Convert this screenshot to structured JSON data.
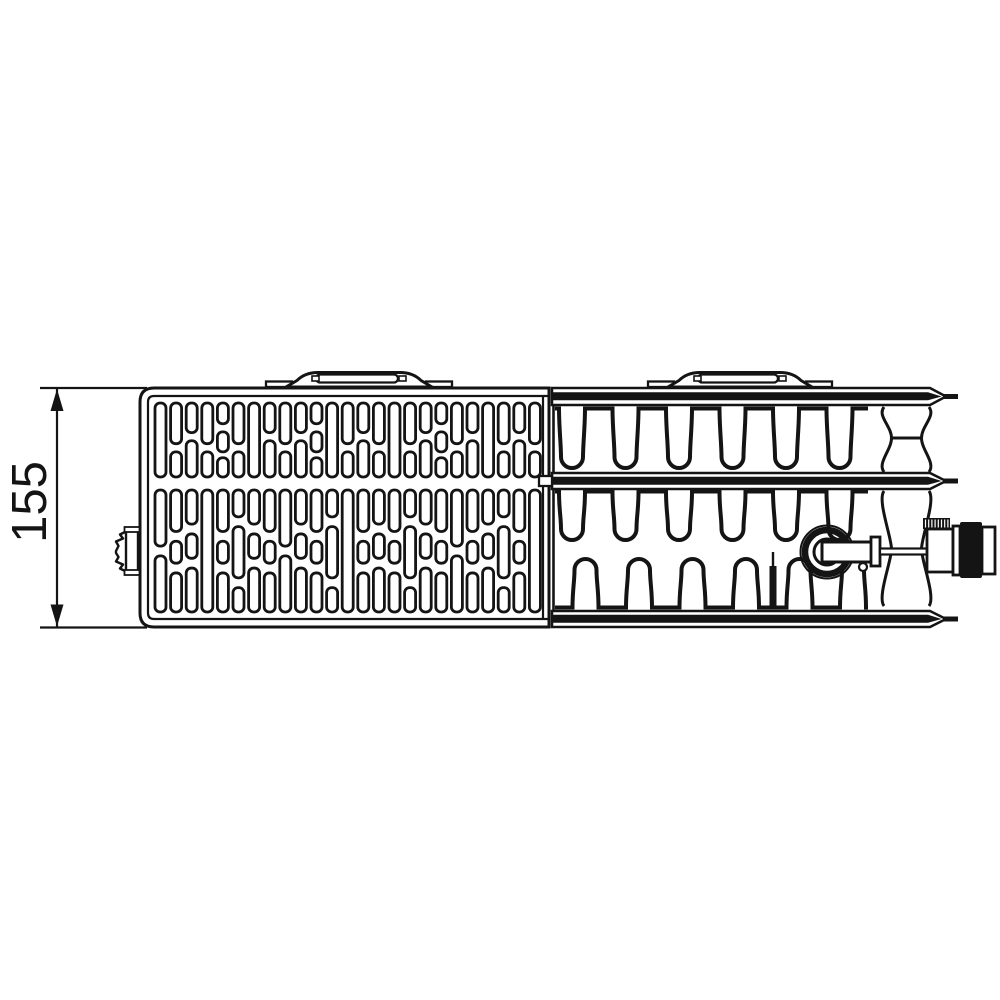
{
  "page": {
    "background": "#ffffff"
  },
  "diagram": {
    "type": "technical-drawing",
    "subject": "panel-radiator-top-view",
    "dimension_label": "155",
    "line_color": "#141414",
    "bg_color": "#ffffff",
    "dimension": {
      "ext_x0": 40,
      "ext_x1": 147,
      "line_x": 57,
      "top_y": 388,
      "bottom_y": 627.5,
      "arrow_len": 23,
      "arrow_half_w": 6.5,
      "label_x": 46,
      "label_y": 502,
      "font_size": 49
    },
    "grille": {
      "outer": {
        "x": 140,
        "y": 388,
        "right": 549,
        "bottom": 627,
        "corner": 14
      },
      "inner_offset": 8,
      "slots": {
        "start_x": 155,
        "pitch": 15.6,
        "width": 11,
        "cols": 25,
        "stroke": 2.8,
        "corner": 5
      },
      "bands": [
        {
          "y": 403,
          "h": 74,
          "sequence": [
            "t",
            "a",
            "b",
            "a",
            "c",
            "a",
            "t",
            "b",
            "a",
            "b",
            "c",
            "t",
            "a",
            "b",
            "a",
            "t",
            "a",
            "b",
            "c",
            "a",
            "b",
            "t",
            "a",
            "b",
            "a"
          ]
        },
        {
          "y": 490,
          "h": 122,
          "sequence": [
            "c",
            "a",
            "b",
            "t",
            "a",
            "d",
            "b",
            "a",
            "c",
            "b",
            "a",
            "d",
            "t",
            "a",
            "b",
            "a",
            "d",
            "b",
            "a",
            "c",
            "a",
            "b",
            "d",
            "a",
            "t"
          ]
        }
      ],
      "patterns_band1": {
        "t": [
          [
            0,
            1
          ]
        ],
        "a": [
          [
            0,
            0.55
          ],
          [
            0.66,
            1
          ]
        ],
        "b": [
          [
            0,
            0.4
          ],
          [
            0.51,
            1
          ]
        ],
        "c": [
          [
            0,
            0.28
          ],
          [
            0.39,
            0.66
          ],
          [
            0.74,
            1
          ]
        ]
      },
      "patterns_band2": {
        "t": [
          [
            0,
            1
          ]
        ],
        "a": [
          [
            0,
            0.34
          ],
          [
            0.42,
            0.6
          ],
          [
            0.68,
            1
          ]
        ],
        "b": [
          [
            0,
            0.28
          ],
          [
            0.36,
            0.56
          ],
          [
            0.64,
            1
          ]
        ],
        "c": [
          [
            0,
            0.46
          ],
          [
            0.54,
            1
          ]
        ],
        "d": [
          [
            0,
            0.22
          ],
          [
            0.3,
            0.72
          ],
          [
            0.8,
            1
          ]
        ]
      }
    },
    "convector": {
      "left_edge_x": 553.5,
      "grille_edge_inner_x": 543,
      "bands": [
        {
          "top": 388,
          "bottom": 405
        },
        {
          "top": 473,
          "bottom": 489
        },
        {
          "top": 611,
          "bottom": 627
        }
      ],
      "tip_x": 930,
      "tip_point_x": 946,
      "bar_x0": 553,
      "bar_x1": 928,
      "bar_tip": 941.5,
      "bar_h": 8,
      "stub_x1": 958,
      "stub_w": 5,
      "mid_band_tab": {
        "x": 539,
        "y": 476,
        "w": 13,
        "h": 10
      },
      "fins": {
        "stroke": 4,
        "tube_half": 13,
        "r": 11,
        "row1": {
          "x_start": 555,
          "x_end": 868,
          "top": 408.5,
          "side_bottom": 457,
          "c0": 572,
          "pitch": 53.5,
          "count": 6
        },
        "row2_upper": {
          "x_start": 555,
          "x_end": 868,
          "top": 491.5,
          "side_bottom": 529,
          "c0": 572,
          "pitch": 53.5,
          "count": 6
        },
        "row2_lower": {
          "x_start": 555,
          "x_end": 868,
          "bottom": 607.5,
          "side_top": 570,
          "c0": 585.5,
          "pitch": 53.5,
          "count": 6
        }
      },
      "channel": {
        "xl": 884,
        "xr": 929,
        "bulge": 7,
        "pinch": 7.5,
        "upper": {
          "y0": 407,
          "y1": 472,
          "waist": 438,
          "waist_line": true
        },
        "lower": {
          "y0": 491,
          "y1": 606,
          "waist": 549,
          "waist_line": false
        }
      }
    },
    "brackets": {
      "y_foot_top": 381.5,
      "foot_h": 5.5,
      "foot_w": 26,
      "top_y": 372.5,
      "plate_y": 374.5,
      "plate_h": 8,
      "items": [
        {
          "x0": 266,
          "x1": 452
        },
        {
          "x0": 648,
          "x1": 832
        }
      ]
    },
    "valve": {
      "ring": {
        "cx": 827,
        "cy": 552,
        "r_outer_thin": 26.5,
        "r_outer": 22,
        "r_inner": 13
      },
      "pipe": {
        "x": 822,
        "y": 542,
        "w": 50,
        "h": 20
      },
      "flange": {
        "x": 871,
        "y": 537,
        "w": 9,
        "h": 29
      },
      "rod": {
        "x": 880,
        "y": 548.5,
        "w": 48,
        "h": 6
      },
      "bleed_circle": {
        "cx": 863,
        "cy": 567,
        "r": 4
      },
      "fitting": {
        "knurl": {
          "x": 923,
          "y": 518,
          "w": 27,
          "h": 11
        },
        "body": {
          "x": 927,
          "y": 529,
          "w": 26,
          "h": 43
        },
        "collar": {
          "x": 953,
          "y": 526,
          "w": 7,
          "h": 49
        },
        "cylinder": {
          "x": 960,
          "y": 522,
          "w": 22,
          "h": 56
        },
        "cap": {
          "x": 982,
          "y": 527,
          "w": 13,
          "h": 47
        }
      },
      "weld_bar": {
        "x": 769.5,
        "y": 566,
        "w": 7,
        "h": 42
      }
    },
    "vent_plug": {
      "flange": {
        "x": 126,
        "y": 528,
        "w": 12,
        "h": 46
      },
      "lip_top": {
        "x": 124.5,
        "y": 527,
        "w": 15,
        "h": 5
      },
      "lip_bottom": {
        "x": 124.5,
        "y": 570,
        "w": 15,
        "h": 5
      },
      "profile_points": "127,531 120,534.5 123,538.5 116,541.5 118.5,546 116,551 116,553 118.5,557 116,561.5 123,564.5 120,568.5 127,572"
    }
  }
}
